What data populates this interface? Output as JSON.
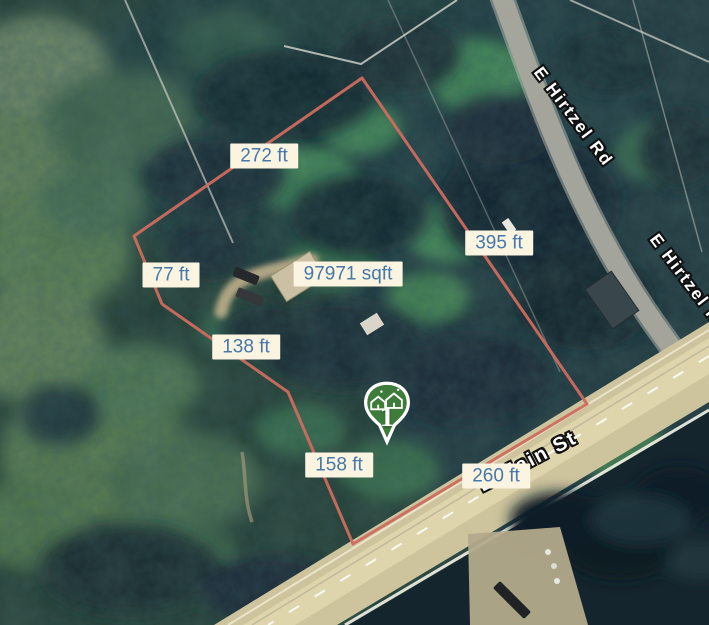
{
  "map_type": "satellite",
  "colors": {
    "boundary": "#cd6c5e",
    "label_bg": "#faf4e1",
    "label_text": "#4678aa",
    "marker_fill": "#3e7c39",
    "marker_border": "#ffffff",
    "street_text": "#ffffff"
  },
  "measurements": {
    "top_edge": "272 ft",
    "left_upper_edge": "77 ft",
    "area": "97971 sqft",
    "right_edge": "395 ft",
    "left_middle_edge": "138 ft",
    "left_lower_edge": "158 ft",
    "bottom_edge": "260 ft"
  },
  "streets": {
    "hirtzel": "E Hirtzel Rd",
    "main": "E Main St"
  },
  "marker": {
    "label": "1"
  }
}
